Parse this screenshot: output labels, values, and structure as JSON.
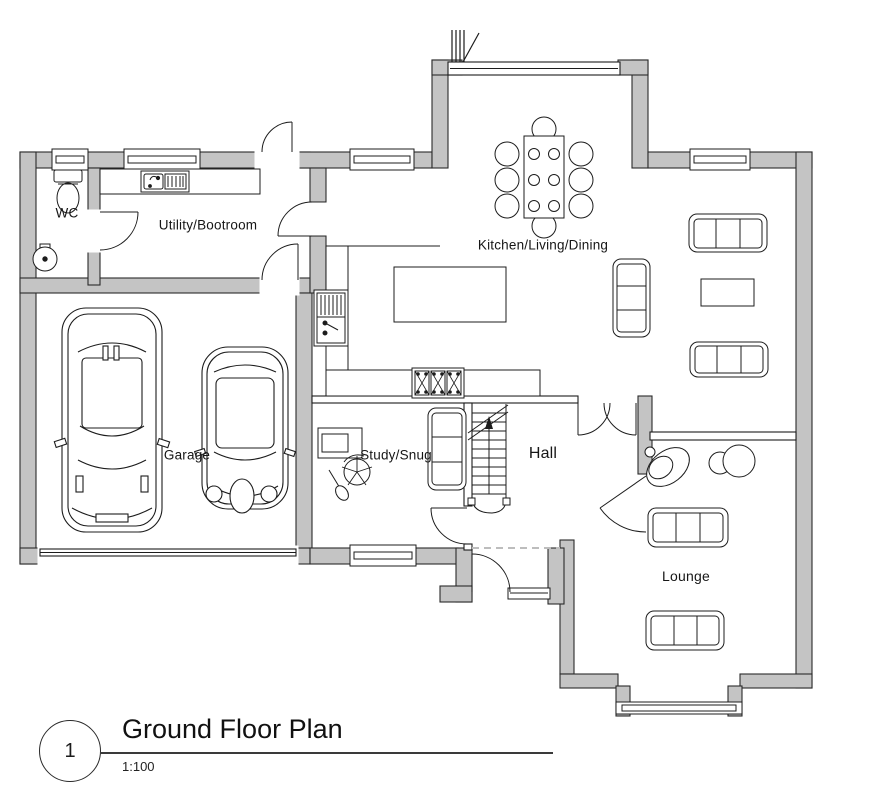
{
  "drawing": {
    "number": "1",
    "title": "Ground Floor Plan",
    "scale": "1:100"
  },
  "rooms": {
    "wc": "WC",
    "utility": "Utility/Bootroom",
    "kitchen": "Kitchen/Living/Dining",
    "garage": "Garage",
    "study": "Study/Snug",
    "hall": "Hall",
    "lounge": "Lounge"
  },
  "colors": {
    "wall_fill": "#c4c4c4",
    "line": "#1c1c1c",
    "background": "#ffffff",
    "dashed_line": "#bdbdbd"
  },
  "symbols": {
    "stairs_direction": "up",
    "doors": [
      "bifold-patio-door",
      "back-door",
      "front-door",
      "garage-vehicle-door",
      "wc-door",
      "kitchen-door",
      "garage-internal-door",
      "kitchen-hall-double-door",
      "hall-lounge-door",
      "study-door"
    ],
    "windows": [
      "wc-window",
      "utility-window",
      "kitchen-left-window",
      "kitchen-right-window",
      "study-window",
      "porch-sidelight",
      "lounge-bay-window"
    ],
    "furniture": [
      "toilet",
      "wash-basin",
      "utility-sink",
      "kitchen-counter",
      "tall-unit",
      "range-cooker",
      "kitchen-island",
      "dining-table",
      "dining-chairs-x8",
      "sofa-x5",
      "coffee-table-x2",
      "swivel-chair",
      "side-tables",
      "desk",
      "office-chair",
      "staircase",
      "car-large",
      "car-small"
    ]
  }
}
